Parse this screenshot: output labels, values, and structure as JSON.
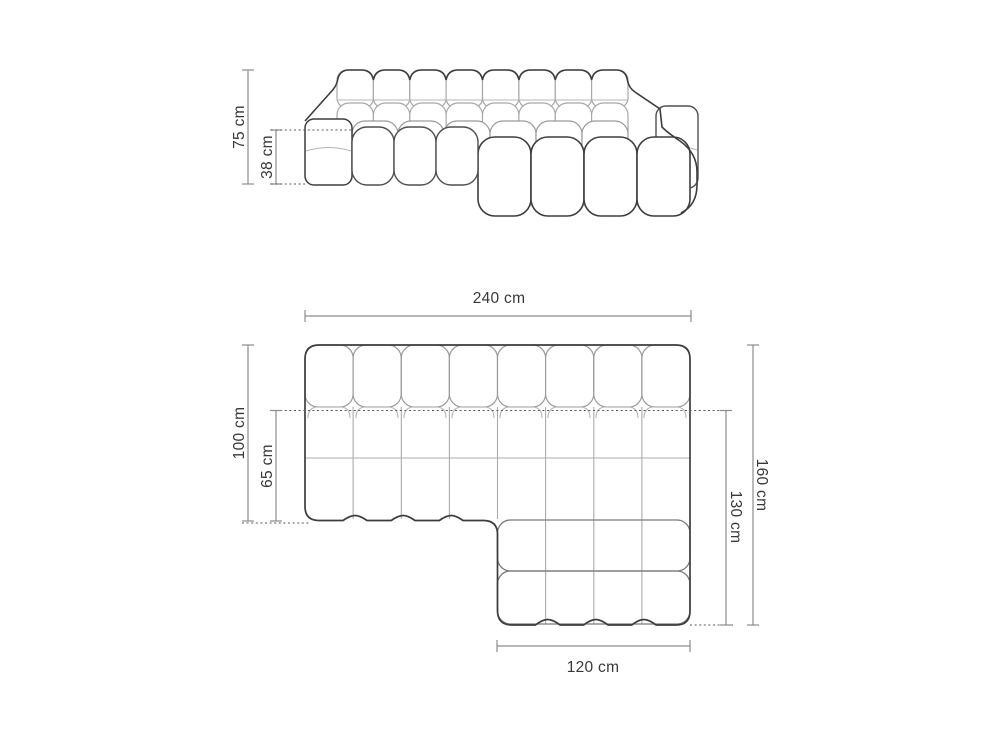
{
  "diagram": {
    "type": "furniture-dimension-diagram",
    "subject": "modular-chaise-sofa",
    "views": {
      "front": {
        "dims": {
          "total_height": "75 cm",
          "seat_height": "38 cm"
        }
      },
      "plan": {
        "dims": {
          "total_width": "240 cm",
          "body_depth": "100 cm",
          "seat_depth": "65 cm",
          "total_depth": "160 cm",
          "chaise_depth": "130 cm",
          "chaise_width": "120 cm"
        }
      }
    },
    "colors": {
      "outline_dark": "#3d3d3d",
      "seam_light": "#a8a8a8",
      "dimension_line": "#8c8c8c",
      "label_text": "#383838",
      "background": "#ffffff"
    }
  }
}
